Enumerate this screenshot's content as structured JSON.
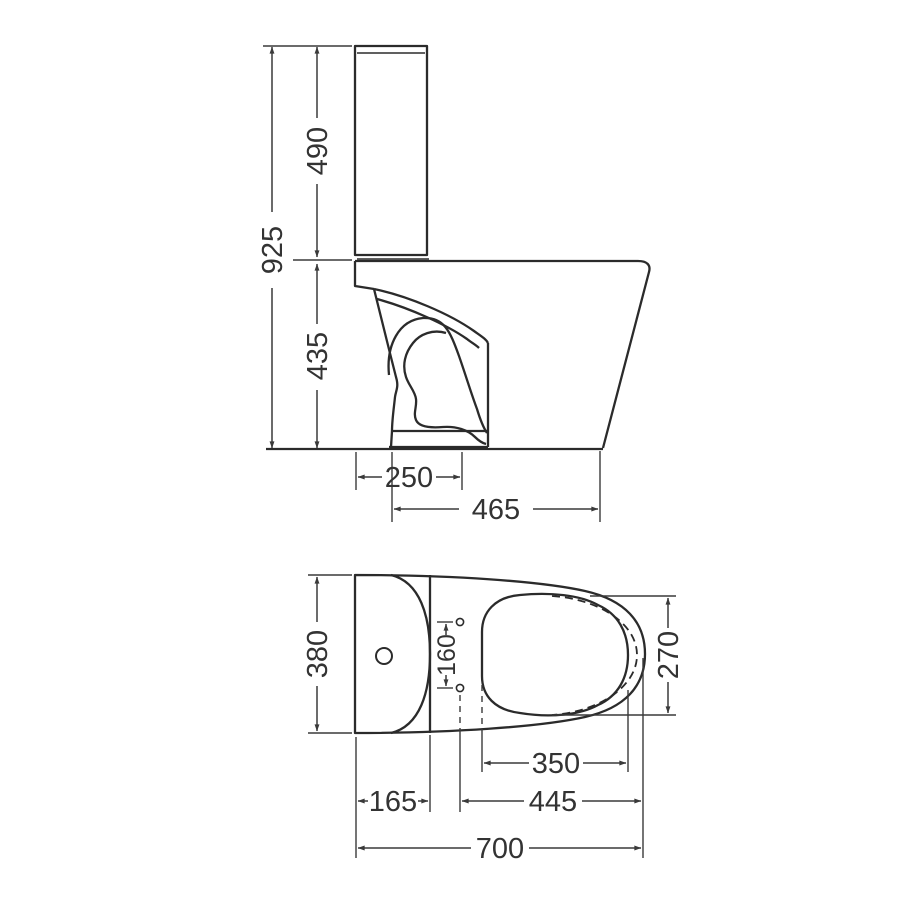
{
  "colors": {
    "background": "#ffffff",
    "object_line": "#2b2b2b",
    "dimension_line": "#3a3a3a",
    "text": "#333333"
  },
  "views": {
    "side": {
      "dimensions": {
        "overall_height": "925",
        "tank_height": "490",
        "bowl_height": "435",
        "trap_offset": "250",
        "bowl_depth": "465"
      }
    },
    "plan": {
      "dimensions": {
        "overall_width": "380",
        "hinge_hole_spacing": "160",
        "bowl_opening_width": "270",
        "bowl_opening_length": "350",
        "tank_depth": "165",
        "hinge_to_front": "445",
        "overall_depth": "700"
      }
    }
  }
}
